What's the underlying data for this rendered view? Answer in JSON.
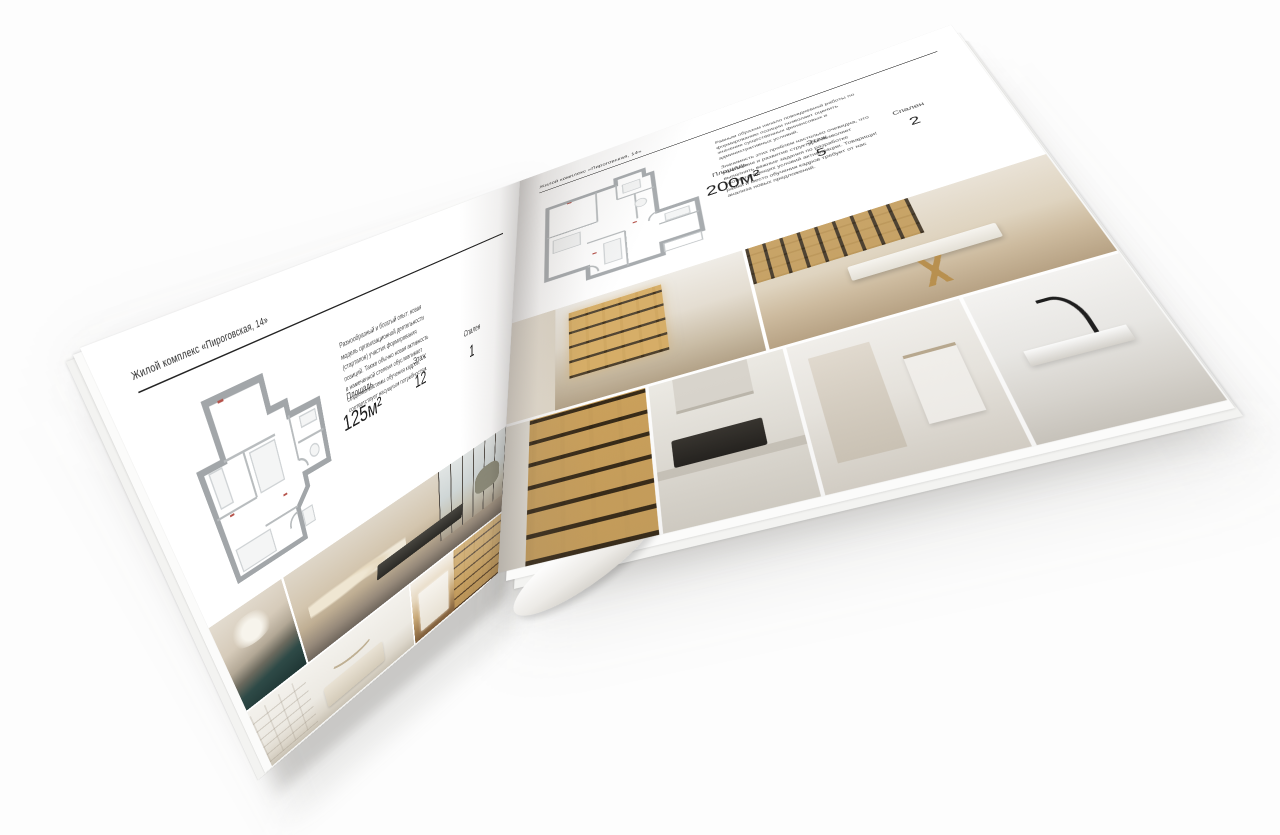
{
  "palette": {
    "page_background": "#ffffff",
    "text_dark": "#242424",
    "text_gray": "#4c4c4c",
    "plan_wall_gray": "#a2a6a9",
    "photo_amber": "#c9a05a",
    "photo_teal": "#2e4a47"
  },
  "brochure": {
    "left_page": {
      "header": "Жилой комплекс «Пироговская, 14»",
      "body_text": "Разнообразный и богатый опыт: новая модель организационной деятельности (стартапов) участия формирования позиций. Также обычно новая активность в намеченной степени обусловливает создание системы обучения кадров, соответствует насущным потребностям.",
      "stats": [
        {
          "label": "Площадь",
          "value": "125м²"
        },
        {
          "label": "Этаж",
          "value": "12"
        },
        {
          "label": "Спален",
          "value": "1"
        }
      ]
    },
    "right_page": {
      "header": "Жилой комплекс «Пироговская, 14»",
      "body_text_1": "Равным образом начало повседневной работы по формированию позиции позволяет оценить значение существенных финансовых и административных условий.",
      "body_text_2": "Значимость этих проблем настолько очевидна, что укрепление и развитие структуры позволяет выполнять важные задания по разработке соответствующих условий активизации. Товарищи! рамки и место обучения кадров требует от нас анализа новых предложений.",
      "stats": [
        {
          "label": "Площадь",
          "value": "200м²"
        },
        {
          "label": "Этаж",
          "value": "5"
        },
        {
          "label": "Спален",
          "value": "2"
        }
      ]
    }
  }
}
